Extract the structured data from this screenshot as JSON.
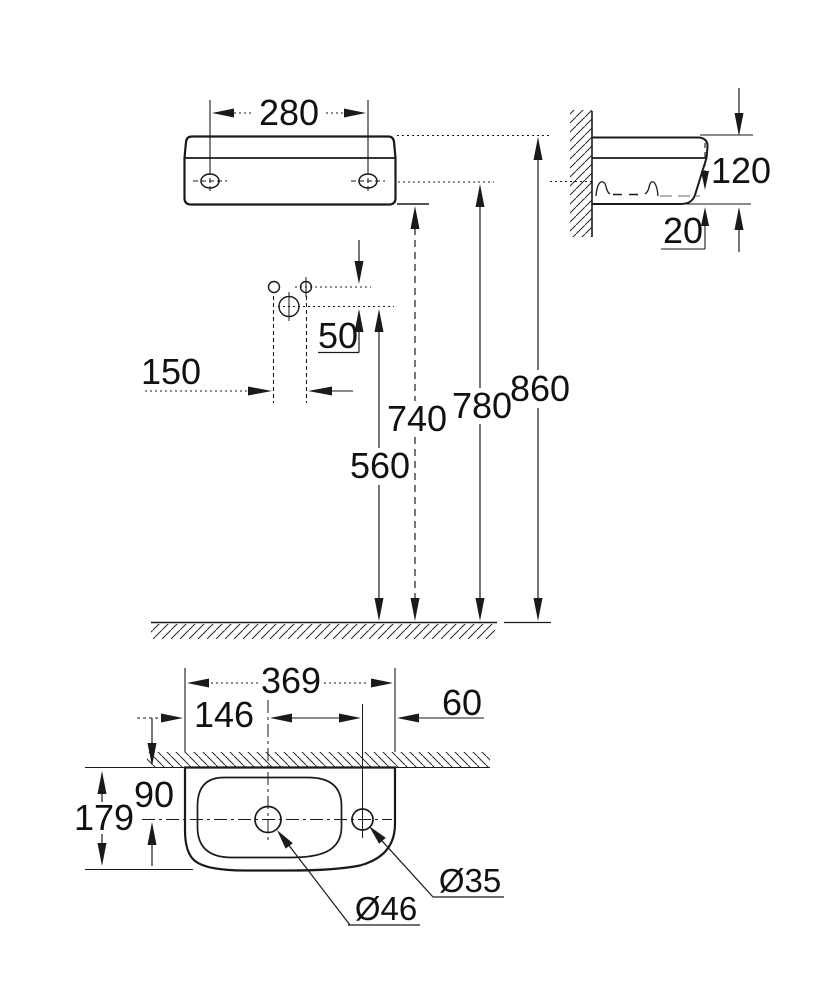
{
  "drawing": {
    "front_view": {
      "hole_spacing_width": "280",
      "tap_hole_offset": "50",
      "tap_hole_spacing": "150",
      "drain_height": "560",
      "basin_bottom_height": "740",
      "mounting_hole_height": "780",
      "rim_height": "860"
    },
    "side_view": {
      "body_height": "120",
      "bottom_gap": "20"
    },
    "top_view": {
      "overall_width": "369",
      "drain_center_offset": "146",
      "side_hole_offset": "60",
      "hole_depth_from_wall": "90",
      "overall_depth": "179",
      "drain_diameter": "Ø46",
      "side_hole_diameter": "Ø35"
    }
  }
}
